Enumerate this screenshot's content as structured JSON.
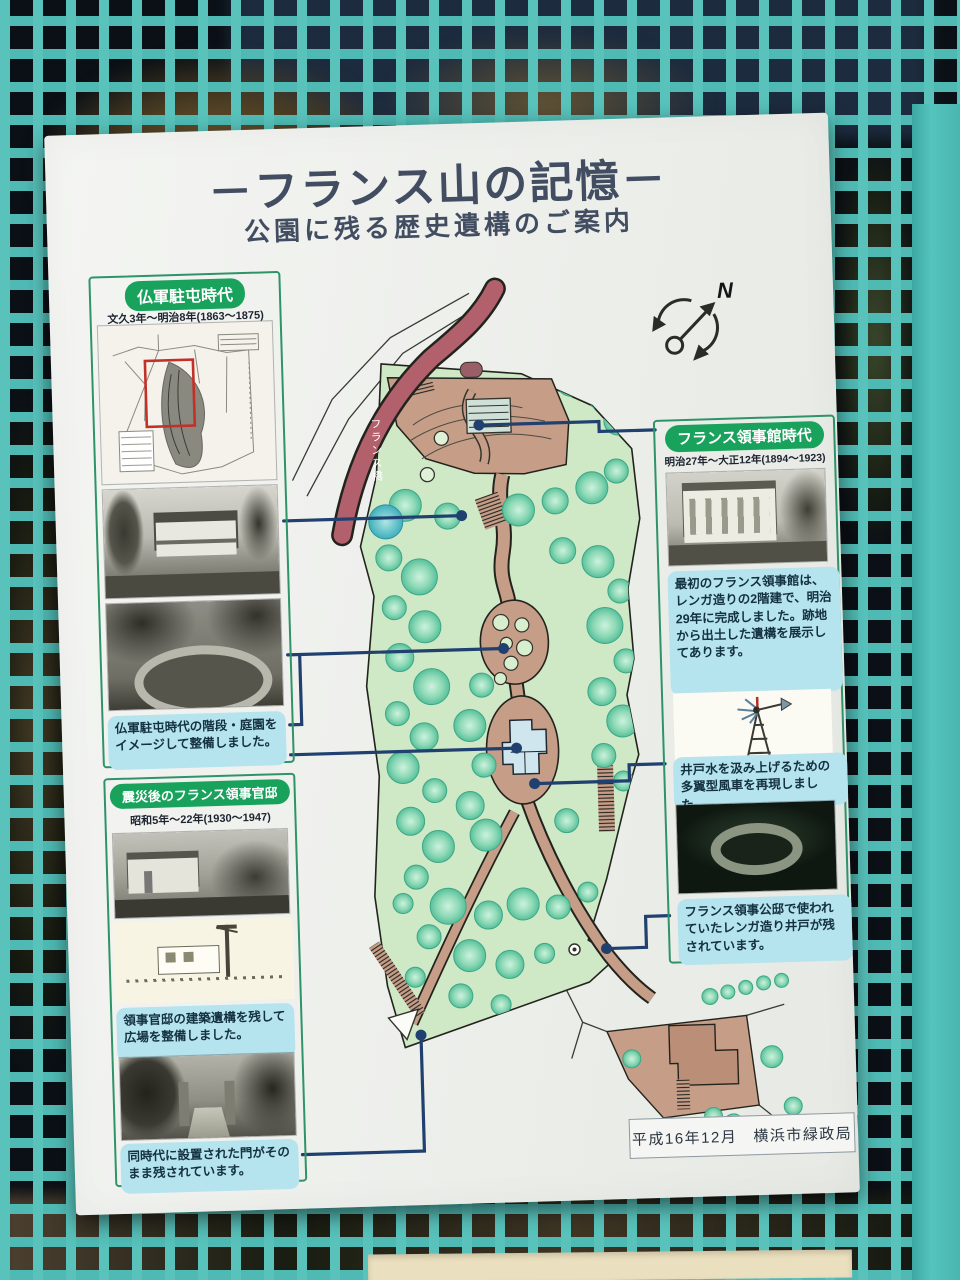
{
  "sign": {
    "title": "－フランス山の記憶－",
    "subtitle": "公園に残る歴史遺構のご案内",
    "sections": {
      "army": {
        "header": "仏軍駐屯時代",
        "period": "文久3年～明治8年(1863～1875)",
        "caption_garden": "仏軍駐屯時代の階段・庭園をイメージして整備しました。"
      },
      "residence": {
        "header": "震災後のフランス領事官邸",
        "period": "昭和5年～22年(1930～1947)",
        "caption_plaza": "領事官邸の建築遺構を残して広場を整備しました。",
        "caption_gate": "同時代に設置された門がそのまま残されています。"
      },
      "consulate": {
        "header": "フランス領事館時代",
        "period": "明治27年～大正12年(1894～1923)",
        "description": "最初のフランス領事館は、レンガ造りの2階建で、明治29年に完成しました。跡地から出土した遺構を展示してあります。",
        "caption_windmill": "井戸水を汲み上げるための多翼型風車を再現しました。",
        "caption_well": "フランス領事公邸で使われていたレンガ造り井戸が残されています。"
      }
    },
    "map": {
      "bridge_label": "フランス橋",
      "compass_north": "N"
    },
    "credit": {
      "date": "平成16年12月",
      "org": "横浜市緑政局"
    },
    "colors": {
      "fence_teal": "#55c0ba",
      "header_green": "#18a25c",
      "caption_blue": "#b5e3ee",
      "park_green": "#cfe8c6",
      "path_tan": "#c69e88",
      "bridge_red": "#b2606c",
      "connector_navy": "#20406f",
      "title_slate": "#424d61"
    }
  }
}
